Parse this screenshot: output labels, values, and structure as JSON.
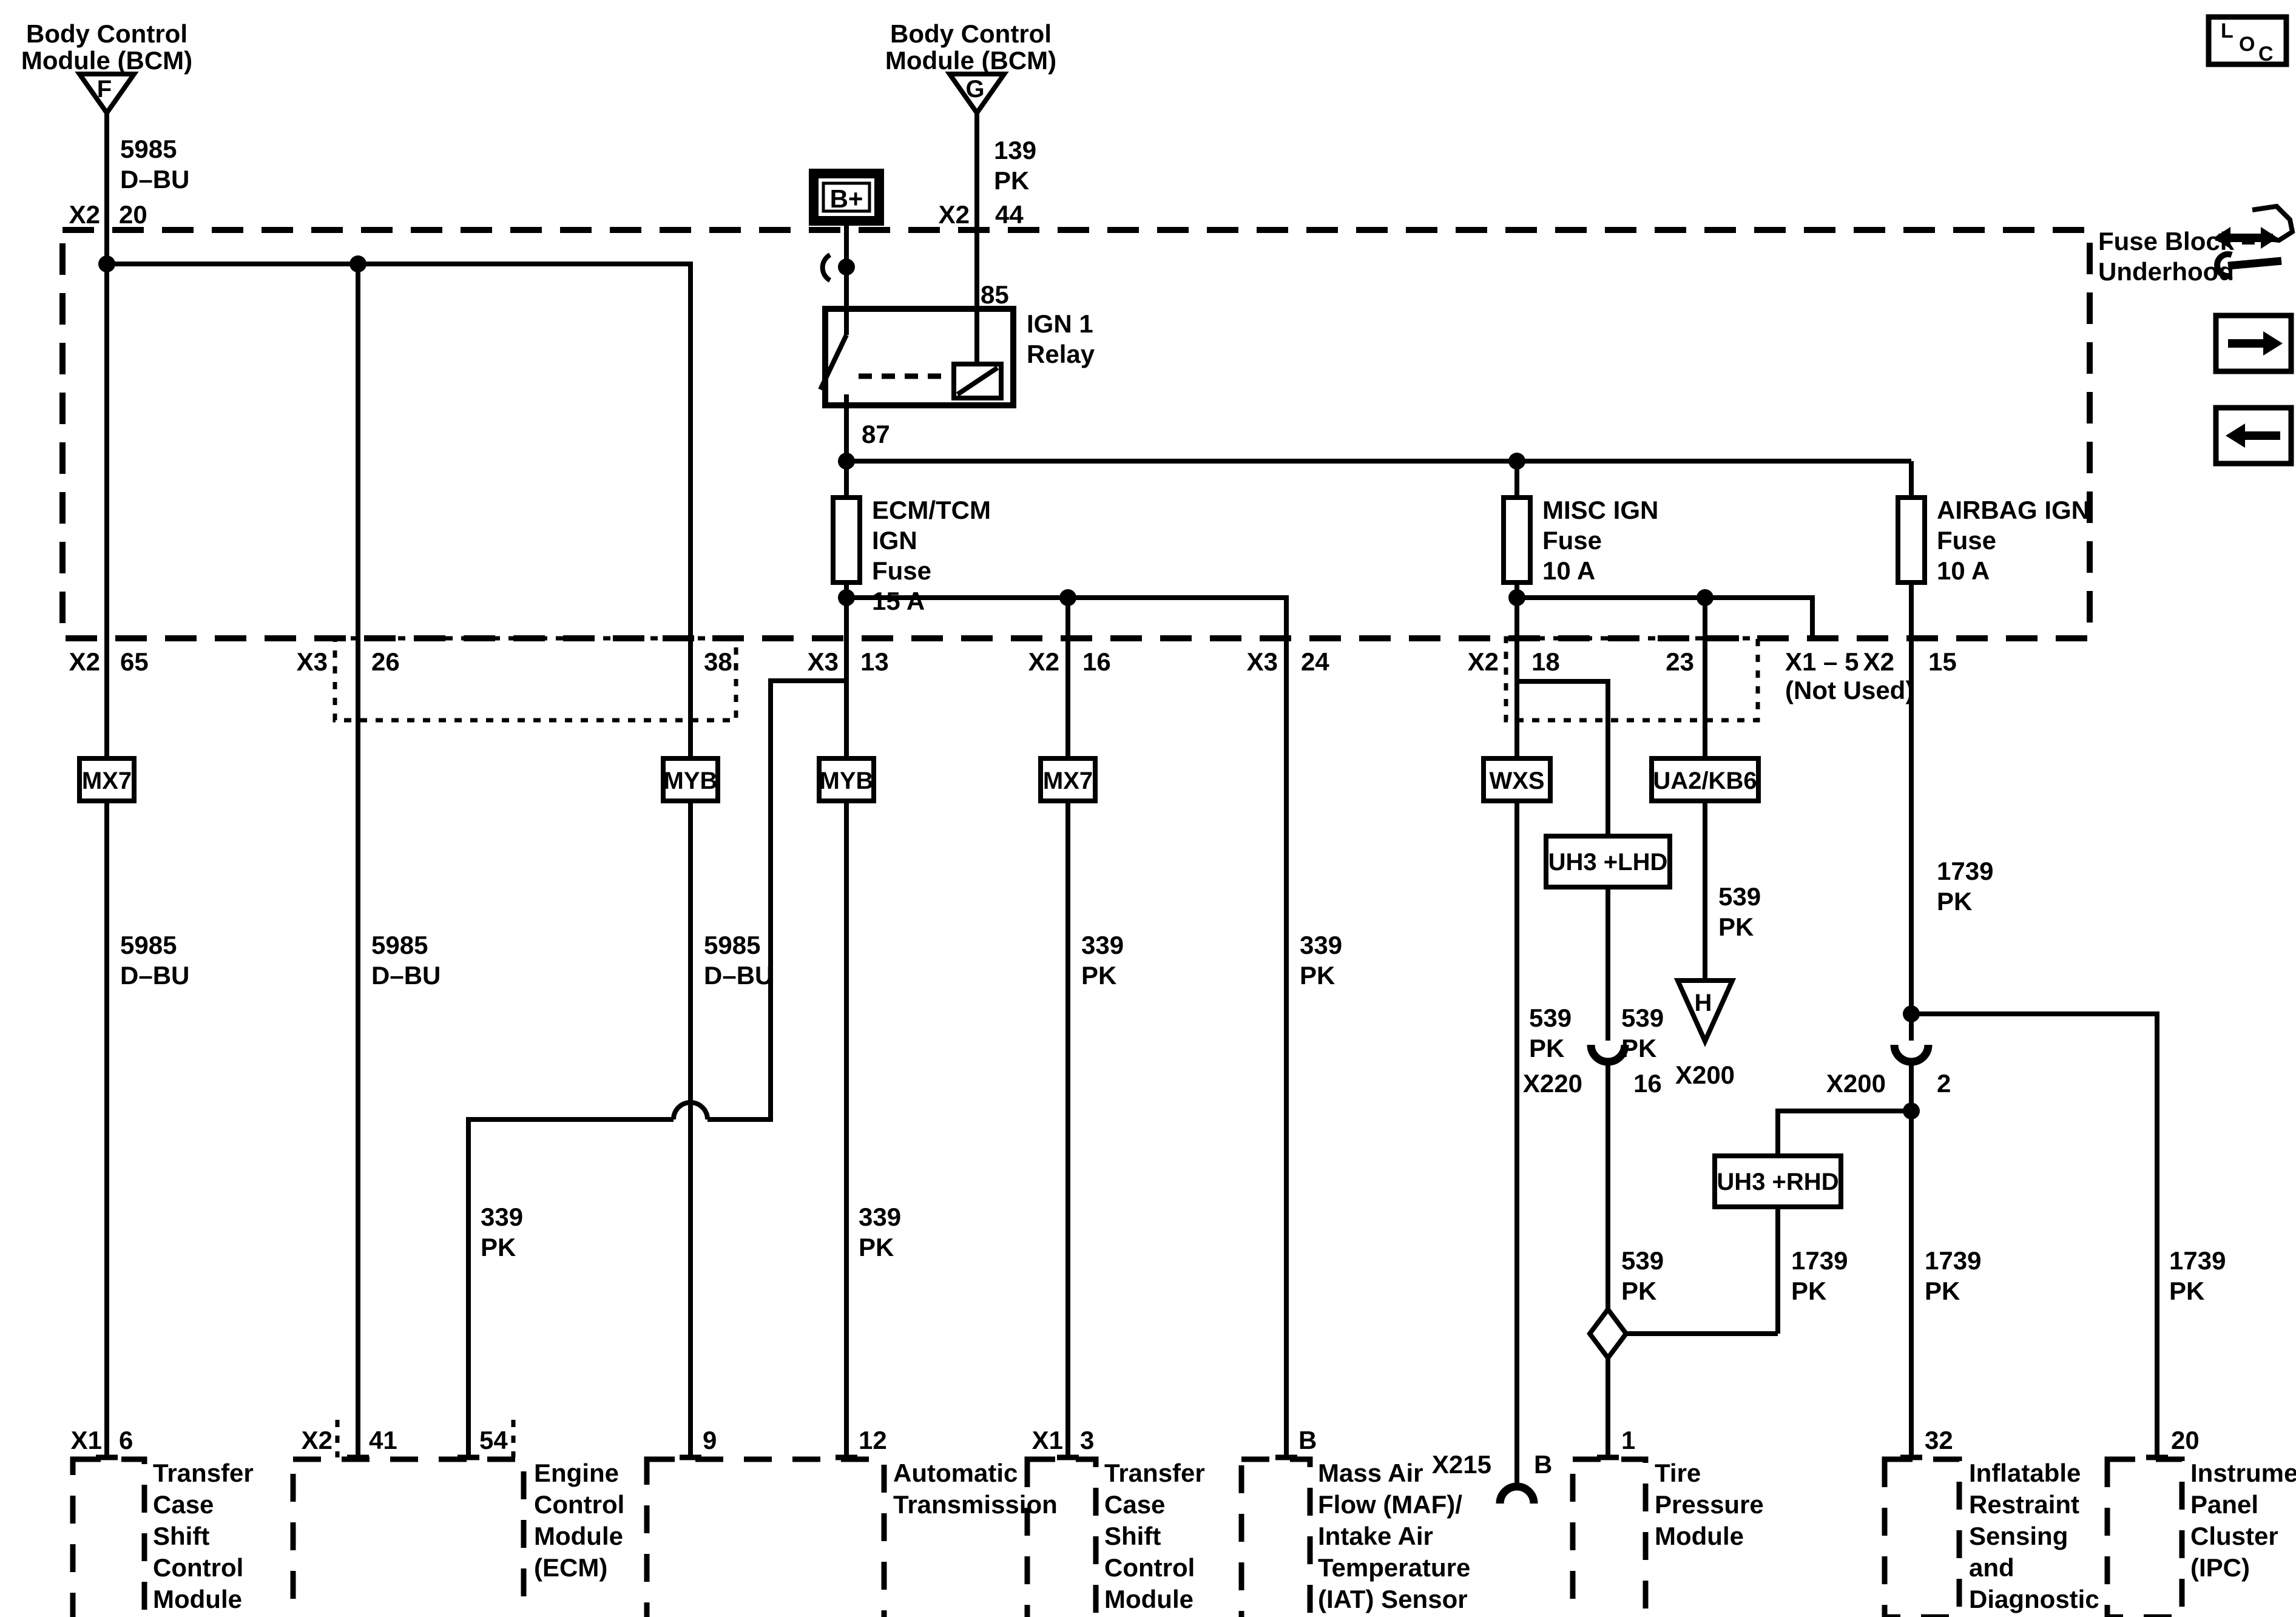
{
  "bcm_left": {
    "name_line1": "Body Control",
    "name_line2": "Module (BCM)",
    "ref": "F",
    "circuit": "5985",
    "color": "D–BU",
    "conn": "X2",
    "pin": "20"
  },
  "bcm_right": {
    "name_line1": "Body Control",
    "name_line2": "Module (BCM)",
    "ref": "G",
    "circuit": "139",
    "color": "PK",
    "conn": "X2",
    "pin": "44"
  },
  "battery": {
    "label": "B+"
  },
  "relay": {
    "pin85": "85",
    "pin87": "87",
    "name_line1": "IGN 1",
    "name_line2": "Relay"
  },
  "fuse_block": {
    "label_line1": "Fuse Block –",
    "label_line2": "Underhood"
  },
  "loc_icon": {
    "l": "L",
    "o": "O",
    "c": "C"
  },
  "fuses": {
    "ecm": {
      "l1": "ECM/TCM",
      "l2": "IGN",
      "l3": "Fuse",
      "l4": "15 A"
    },
    "misc": {
      "l1": "MISC IGN",
      "l2": "Fuse",
      "l3": "10 A"
    },
    "airbag": {
      "l1": "AIRBAG IGN",
      "l2": "Fuse",
      "l3": "10 A"
    }
  },
  "row": {
    "c65": {
      "conn": "X2",
      "pin": "65"
    },
    "c26": {
      "conn": "X3",
      "pin": "26"
    },
    "c38": {
      "pin": "38"
    },
    "c13": {
      "conn": "X3",
      "pin": "13"
    },
    "c16": {
      "conn": "X2",
      "pin": "16"
    },
    "c24": {
      "conn": "X3",
      "pin": "24"
    },
    "c18": {
      "conn": "X2",
      "pin": "18"
    },
    "c23": {
      "pin": "23"
    },
    "not_used_line1": "X1 – 5",
    "not_used_line2": "(Not Used)",
    "c15": {
      "conn": "X2",
      "pin": "15"
    }
  },
  "options": {
    "mx7a": "MX7",
    "myb1": "MYB",
    "myb2": "MYB",
    "mx7b": "MX7",
    "wxs": "WXS",
    "ua2": "UA2/KB6",
    "uh3lhd": "UH3 +LHD",
    "uh3rhd": "UH3 +RHD"
  },
  "circuits": {
    "c5985": "5985",
    "dbu": "D–BU",
    "c339": "339",
    "c539": "539",
    "c1739": "1739",
    "pk": "PK"
  },
  "inline_conns": {
    "x220": {
      "name": "X220",
      "pin": "16"
    },
    "x200": {
      "name": "X200",
      "pin": "2"
    },
    "x215": {
      "name": "X215",
      "pin": "B"
    },
    "h_ref": {
      "ref": "H",
      "conn": "X200"
    }
  },
  "modules": {
    "tc1": {
      "conn": "X1",
      "pin": "6",
      "l1": "Transfer",
      "l2": "Case",
      "l3": "Shift",
      "l4": "Control",
      "l5": "Module"
    },
    "ecm": {
      "conn": "X2",
      "pin1": "41",
      "pin2": "54",
      "l1": "Engine",
      "l2": "Control",
      "l3": "Module",
      "l4": "(ECM)"
    },
    "at": {
      "pin1": "9",
      "pin2": "12",
      "l1": "Automatic",
      "l2": "Transmission"
    },
    "tc2": {
      "conn": "X1",
      "pin": "3",
      "l1": "Transfer",
      "l2": "Case",
      "l3": "Shift",
      "l4": "Control",
      "l5": "Module"
    },
    "maf": {
      "pin": "B",
      "l1": "Mass Air",
      "l2": "Flow (MAF)/",
      "l3": "Intake Air",
      "l4": "Temperature",
      "l5": "(IAT) Sensor"
    },
    "tire": {
      "pin": "1",
      "l1": "Tire",
      "l2": "Pressure",
      "l3": "Module"
    },
    "sdm": {
      "pin": "32",
      "l1": "Inflatable",
      "l2": "Restraint",
      "l3": "Sensing",
      "l4": "and",
      "l5": "Diagnostic",
      "l6": "Module",
      "l7": "(SDM)"
    },
    "ipc": {
      "pin": "20",
      "l1": "Instrument",
      "l2": "Panel",
      "l3": "Cluster",
      "l4": "(IPC)"
    }
  }
}
